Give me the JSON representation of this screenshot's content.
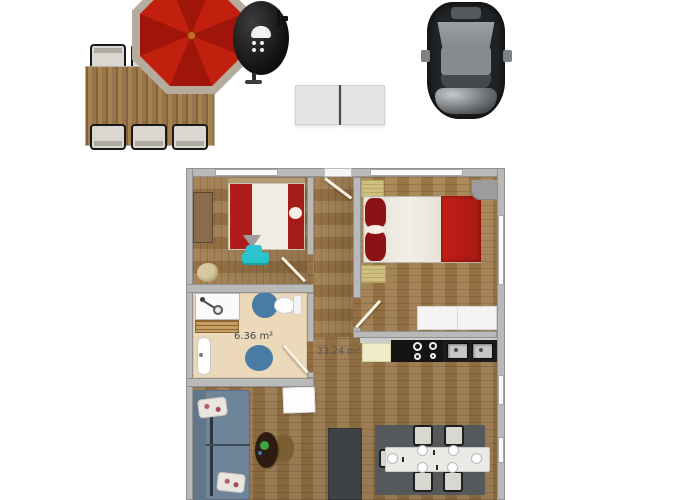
{
  "scene": {
    "background": "#ffffff",
    "type": "apartment-floorplan-render",
    "labels": {
      "bathroom_area": "6.36 m²",
      "living_area": "33.24 m²"
    }
  },
  "outdoor": {
    "objects": [
      "patio-dining-table",
      "patio-chairs-x6",
      "patio-umbrella",
      "kettle-grill",
      "folding-table",
      "car-top-view"
    ],
    "umbrella_canopy": "#c2200f",
    "umbrella_rim": "#b5ac9e",
    "grill_color": "#141414",
    "car_body": "#212426",
    "folding_table_color": "#e4e4e4"
  },
  "floorplan": {
    "rooms": {
      "bedroom_left": {
        "furniture": [
          "double-bed-red-white",
          "wardrobe",
          "teal-ottoman",
          "beanbag"
        ]
      },
      "bedroom_right": {
        "furniture": [
          "double-bed-red-pillows",
          "bedside-mats",
          "corner-desk",
          "white-dresser"
        ]
      },
      "bathroom": {
        "area_label": "6.36 m²",
        "furniture": [
          "shower",
          "bath-mat",
          "sink",
          "toilet",
          "blue-rugs"
        ]
      },
      "living_kitchen": {
        "area_label": "33.24 m²",
        "furniture": [
          "kitchen-counter",
          "cooktop",
          "double-sink",
          "island",
          "sofa",
          "coffee-table",
          "tv-table",
          "dining-table",
          "dining-chairs-x6"
        ]
      }
    },
    "colors": {
      "wall": "#b9b9b9",
      "wood_floor": "#9d7a4b",
      "bathroom_floor": "#ebd9b9",
      "bed_red": "#b41d1a",
      "pillow_dark_red": "#8c1216",
      "sofa_blue": "#6e8499",
      "rug_blue": "#4a7ba5",
      "ottoman_teal": "#2bc4cd",
      "island_gray": "#3e4244",
      "dining_rug_gray": "#56595c"
    }
  }
}
